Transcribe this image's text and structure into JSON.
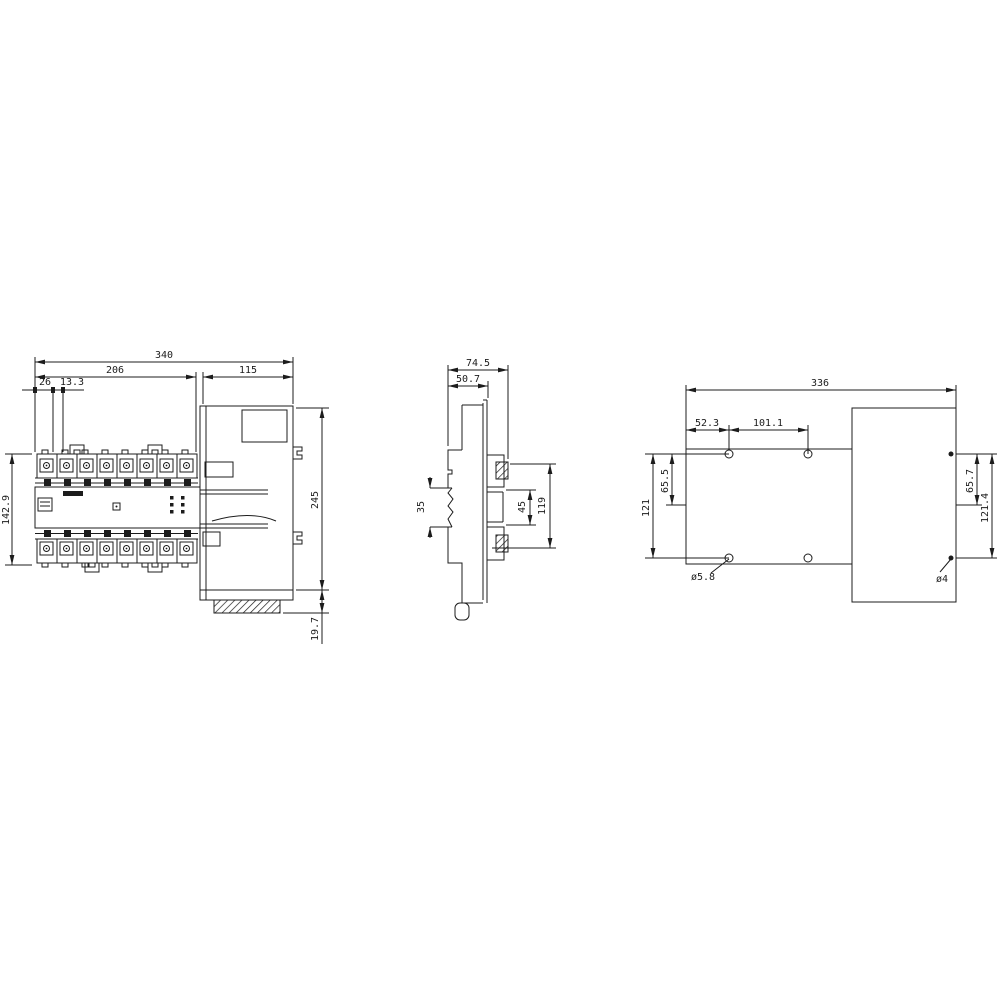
{
  "drawing": {
    "background": "#ffffff",
    "stroke": "#1c1c1c",
    "views": {
      "front": {
        "label": "front-view",
        "dims": {
          "total_width": "340",
          "base_width": "206",
          "actuator_width": "115",
          "first_pole_offset": "26",
          "pole_pitch": "13.3",
          "base_height": "142.9",
          "actuator_height": "245",
          "bottom_offset": "19.7"
        }
      },
      "side": {
        "label": "side-view",
        "dims": {
          "depth_total": "74.5",
          "depth_body": "50.7",
          "din_notch": "35",
          "terminal_span": "45",
          "height": "119"
        }
      },
      "drilling": {
        "label": "drilling-plan",
        "dims": {
          "total_width": "336",
          "hole_offset_x": "52.3",
          "hole_pitch_x": "101.1",
          "hole_span_y": "121",
          "hole_mid_offset_y": "65.5",
          "actuator_hole_mid_offset_y": "65.7",
          "actuator_hole_span_y": "121.4",
          "base_hole_diameter": "ø5.8",
          "actuator_hole_diameter": "ø4"
        }
      }
    }
  }
}
